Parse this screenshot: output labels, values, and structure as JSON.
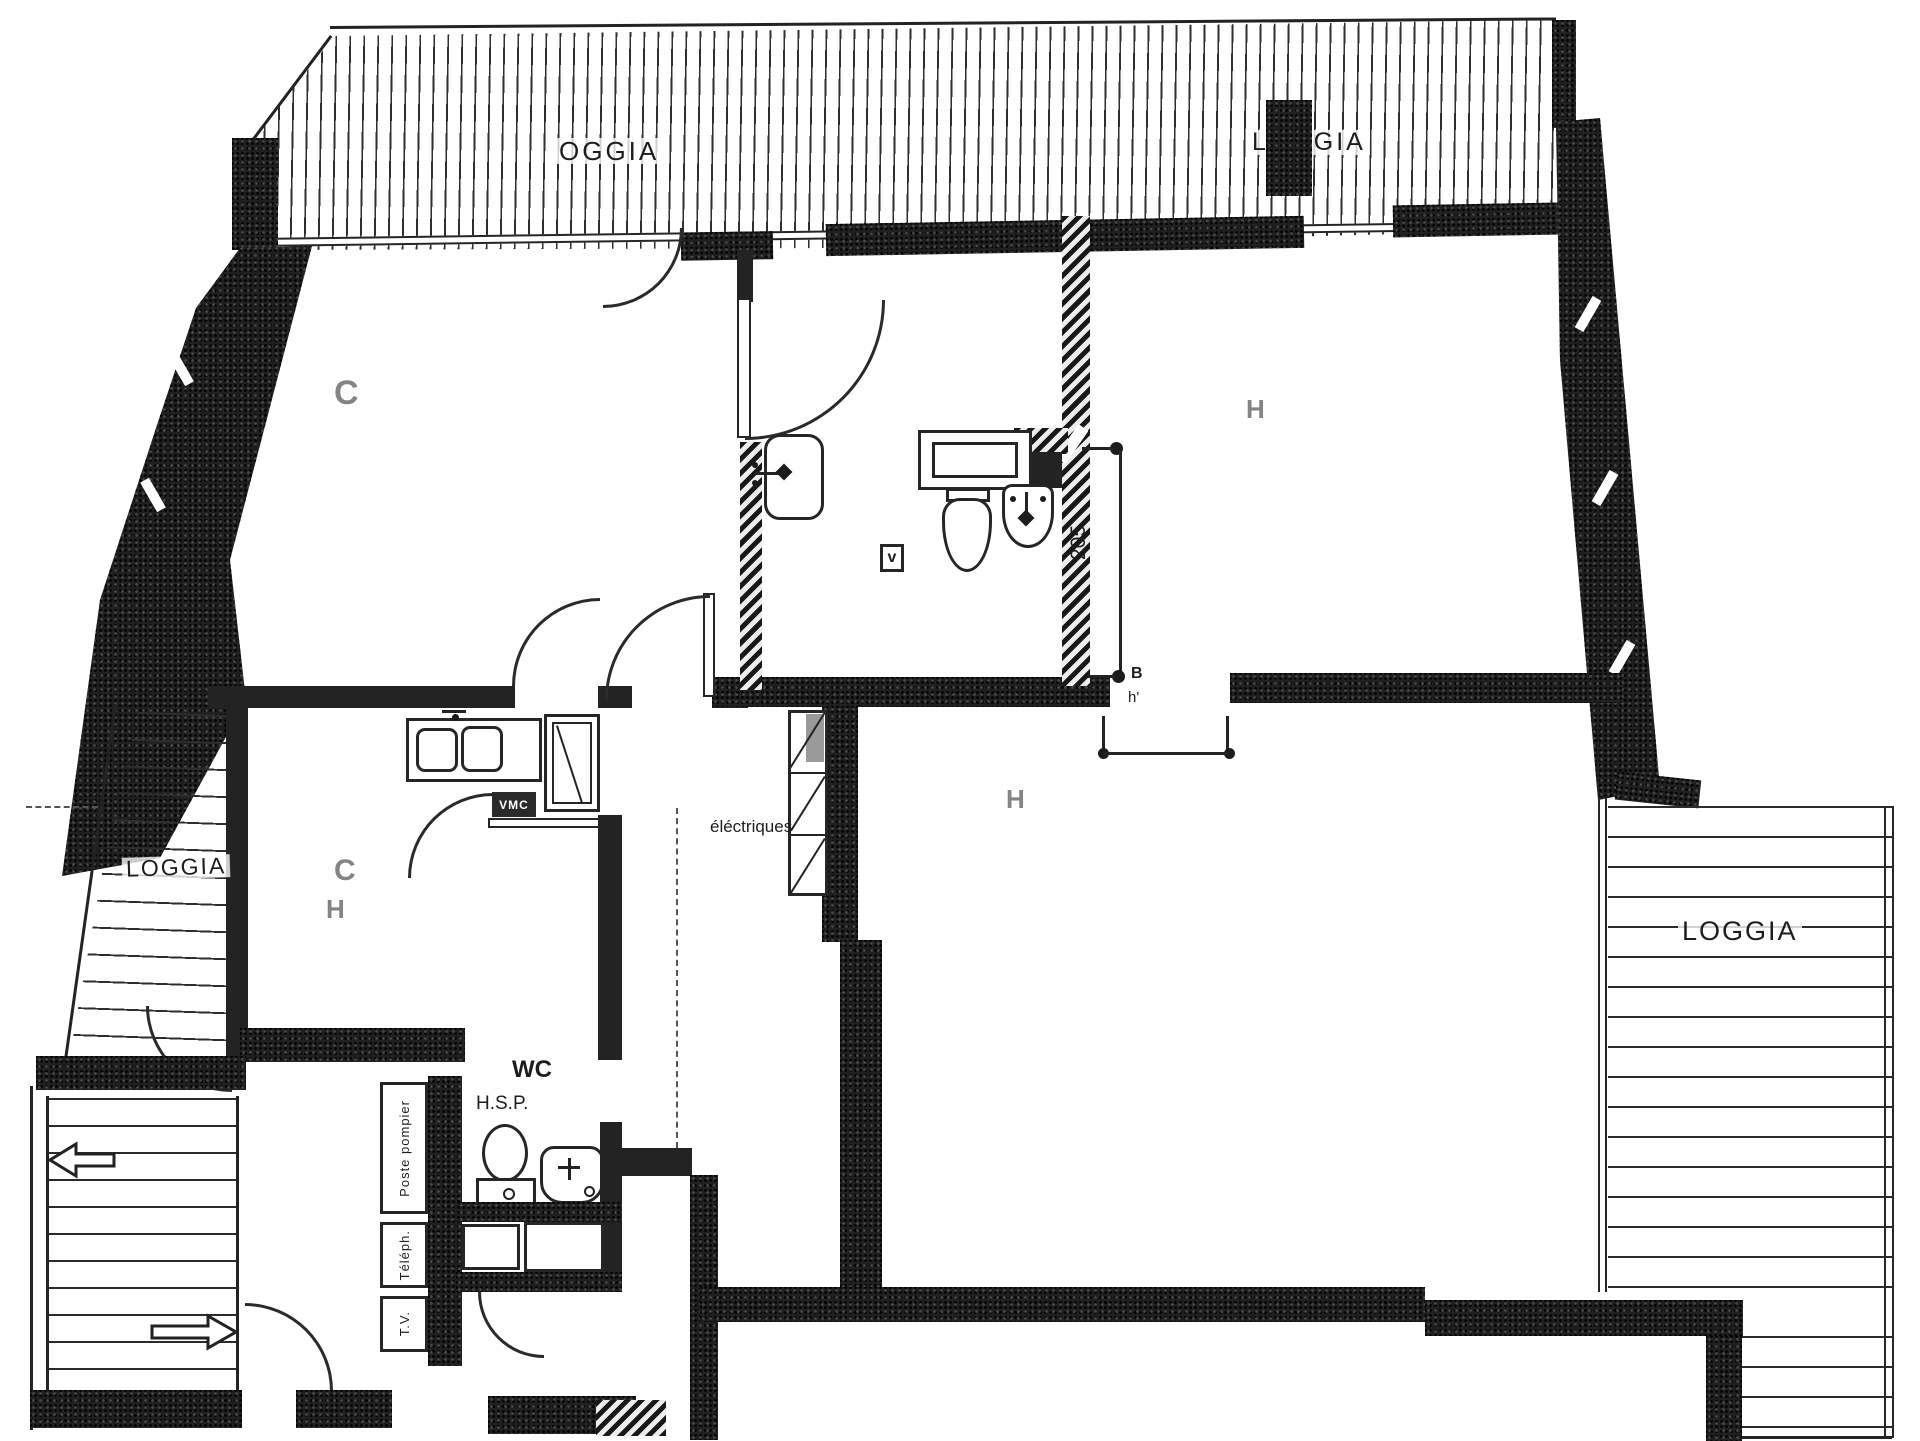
{
  "drawing": {
    "type": "apartment floor plan",
    "loggias": {
      "top_left": "OGGIA",
      "top_right": "LOGGIA",
      "left": "LOGGIA",
      "right": "LOGGIA"
    },
    "room_marks": {
      "bedroom_top_left": "C",
      "bedroom_top_right": "H",
      "kitchen_c": "C",
      "kitchen_h": "H",
      "living": "H"
    },
    "annotations": {
      "electrical": "éléctriques",
      "vmc": "VMC",
      "vent_mark": "v",
      "wc": "WC",
      "hsp": "H.S.P.",
      "poste_pompier": "Poste pompier",
      "telephone": "Téléph.",
      "tv": "T.V."
    },
    "dimensions": {
      "bath_height": "205",
      "point_b": "B",
      "point_h": "h'"
    },
    "colors": {
      "ink": "#1f1f1f",
      "paper": "#ffffff"
    }
  }
}
